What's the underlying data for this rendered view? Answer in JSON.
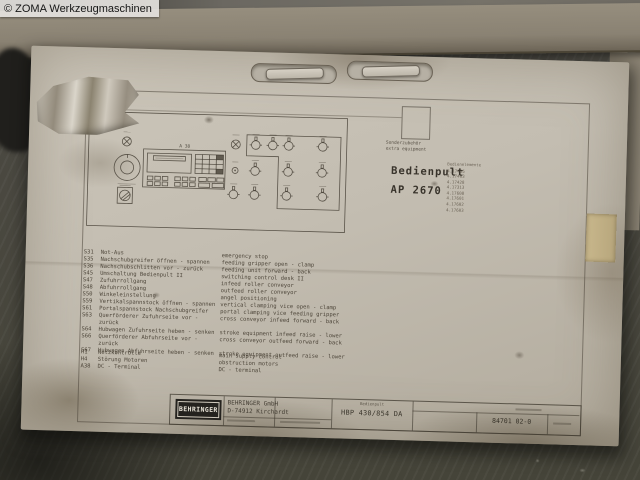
{
  "watermark": "© ZOMA Werkzeugmaschinen",
  "sheet": {
    "panel": {
      "label": "A 38"
    },
    "accessory": {
      "de": "Sonderzubehör",
      "en": "extra equipment"
    },
    "title": {
      "line1": "Bedienpult",
      "line2": "AP 2670"
    },
    "parts_list": {
      "header": "Bedienelemente",
      "items": [
        "4.17405",
        "4.17403",
        "4.17428",
        "4.17313",
        "4.17608",
        "4.17601",
        "4.17602",
        "4.17603"
      ]
    },
    "legend_switches": [
      {
        "code": "S31",
        "de": "Not-Aus",
        "en": "emergency stop"
      },
      {
        "code": "S35",
        "de": "Nachschubgreifer öffnen - spannen",
        "en": "feeding gripper open - clamp"
      },
      {
        "code": "S36",
        "de": "Nachschubschlitten vor - zurück",
        "en": "feeding unit forward - back"
      },
      {
        "code": "S45",
        "de": "Umschaltung Bedienpult II",
        "en": "switching control desk II"
      },
      {
        "code": "S47",
        "de": "Zufuhrrollgang",
        "en": "infeed roller conveyor"
      },
      {
        "code": "S48",
        "de": "Abfuhrrollgang",
        "en": "outfeed roller conveyor"
      },
      {
        "code": "S50",
        "de": "Winkeleinstellung",
        "en": "angel positioning"
      },
      {
        "code": "S59",
        "de": "Vertikalspannstock öffnen - spannen",
        "en": "vertical clamping vice open - clamp"
      },
      {
        "code": "S61",
        "de": "Portalspannstock Nachschubgreifer",
        "en": "portal clamping vice feeding gripper"
      },
      {
        "code": "S63",
        "de": "Querförderer Zufuhrseite vor - zurück",
        "en": "cross conveyor infeed forward - back"
      },
      {
        "code": "S64",
        "de": "Hubwagen Zufuhrseite heben - senken",
        "en": "stroke equipment infeed raise - lower"
      },
      {
        "code": "S66",
        "de": "Querförderer Abfuhrseite vor - zurück",
        "en": "cross conveyor outfeed forward - back"
      },
      {
        "code": "S67",
        "de": "Hubwagen Abfuhrseite heben - senken",
        "en": "stroke equipment outfeed raise - lower"
      }
    ],
    "legend_misc": [
      {
        "code": "H1",
        "de": "Netzkontrolle",
        "en": "main supply control"
      },
      {
        "code": "H4",
        "de": "Störung Motoren",
        "en": "obstruction motors"
      },
      {
        "code": "A38",
        "de": "DC - Terminal",
        "en": "DC - terminal"
      }
    ],
    "title_block": {
      "logo": "BEHRINGER",
      "company": "BEHRINGER GmbH",
      "address": "D-74912 Kirchardt",
      "type_label": "Bedienpult",
      "type_value": "HBP 430/854 DA",
      "drawing_number": "84701 02-0"
    },
    "colors": {
      "paper": "#c6c0b4",
      "ink": "#474239",
      "cardboard": "#8d8577",
      "floor": "#45443d",
      "tape": "#c3b287"
    }
  }
}
